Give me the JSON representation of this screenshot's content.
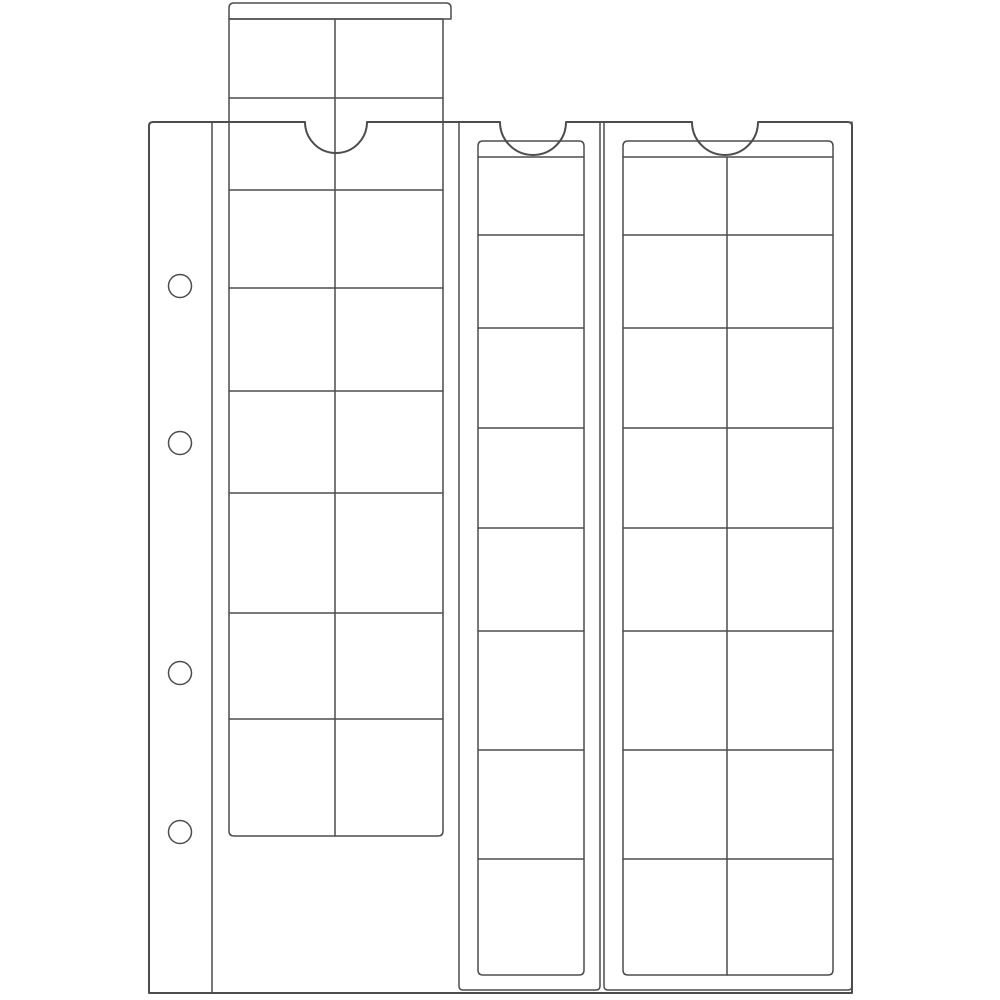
{
  "image": {
    "description": "Line drawing of a transparent coin-album binder page with four ring holes and three vertical sliding pocket strips; the left slide is pulled partly out of the page through a thumb notch",
    "background_color": "#ffffff",
    "line_color": "#4d4d4d"
  },
  "drawing": {
    "canvas": {
      "width": 1000,
      "height": 1000
    },
    "page": {
      "left": 149,
      "top": 122,
      "right": 852,
      "bottom": 993,
      "margin_line_x": 212
    },
    "binder_holes": {
      "count": 4,
      "cx": 180,
      "radius": 11.5,
      "cy_list": [
        286,
        443,
        673,
        832
      ]
    },
    "notches": [
      {
        "center_x": 336,
        "radius": 31
      },
      {
        "center_x": 533,
        "radius": 33
      },
      {
        "center_x": 725,
        "radius": 33
      }
    ],
    "stroke": {
      "main_width": 1.5,
      "page_width": 2
    },
    "total_pockets": 40,
    "strips": [
      {
        "id": "left",
        "outer": null,
        "slide": {
          "band": {
            "x1": 229,
            "x2": 451,
            "y1": 3,
            "y2": 19
          },
          "body": {
            "x1": 229,
            "x2": 443,
            "top": 19,
            "bottom": 836
          },
          "rim_y": null,
          "divider_x": [
            335
          ],
          "row_lines": [
            98,
            190,
            288,
            391,
            493,
            613,
            719
          ],
          "columns": 2,
          "rows": 8,
          "pockets": 16
        }
      },
      {
        "id": "middle",
        "outer": {
          "x1": 459,
          "x2": 600,
          "top": 122,
          "bottom": 990
        },
        "slide": {
          "band": null,
          "body": {
            "x1": 478,
            "x2": 584,
            "top": 141,
            "bottom": 975
          },
          "rim_y": 157,
          "divider_x": [],
          "row_lines": [
            235,
            328,
            428,
            528,
            631,
            750,
            859
          ],
          "columns": 1,
          "rows": 8,
          "pockets": 8
        }
      },
      {
        "id": "right",
        "outer": {
          "x1": 604,
          "x2": 852,
          "top": 122,
          "bottom": 990
        },
        "slide": {
          "band": null,
          "body": {
            "x1": 623,
            "x2": 833,
            "top": 141,
            "bottom": 975
          },
          "rim_y": 157,
          "divider_x": [
            727
          ],
          "row_lines": [
            235,
            328,
            428,
            528,
            631,
            750,
            859
          ],
          "columns": 2,
          "rows": 8,
          "pockets": 16
        }
      }
    ]
  }
}
